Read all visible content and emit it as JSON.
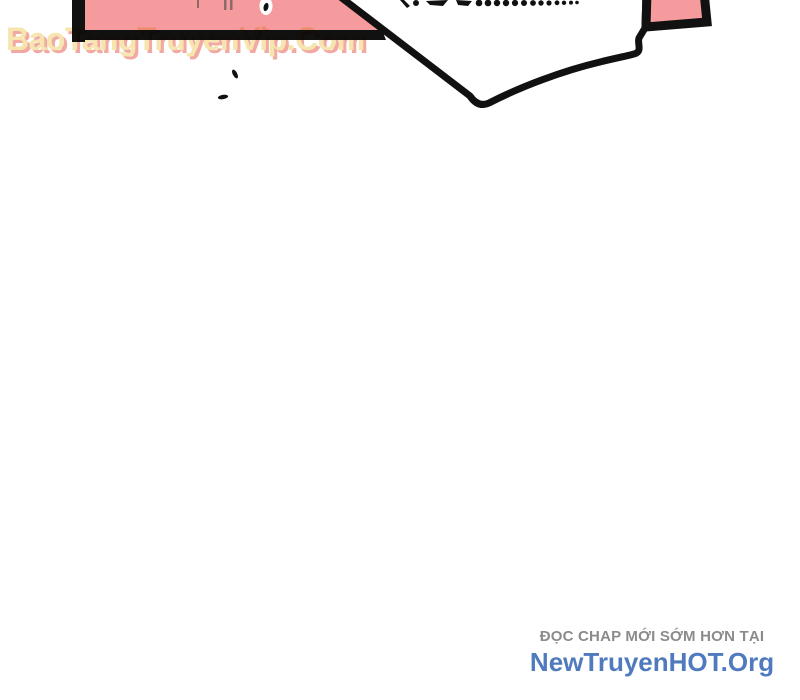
{
  "colors": {
    "bg": "#ffffff",
    "ink": "#111111",
    "panel-pink": "#f59b9d",
    "panel-tick": "#8d6a6a",
    "wm-fill": "#f6e5ae",
    "wm-shadow": "#f2a9a2",
    "footer-gray": "#8b8b8b",
    "footer-blue": "#4f7bbe"
  },
  "watermark": {
    "text": "BaoTangTruyenVip.Com"
  },
  "footer": {
    "line1": "ĐỌC CHAP MỚI SỚM HƠN TẠI",
    "line2": "NewTruyenHOT.Org"
  }
}
